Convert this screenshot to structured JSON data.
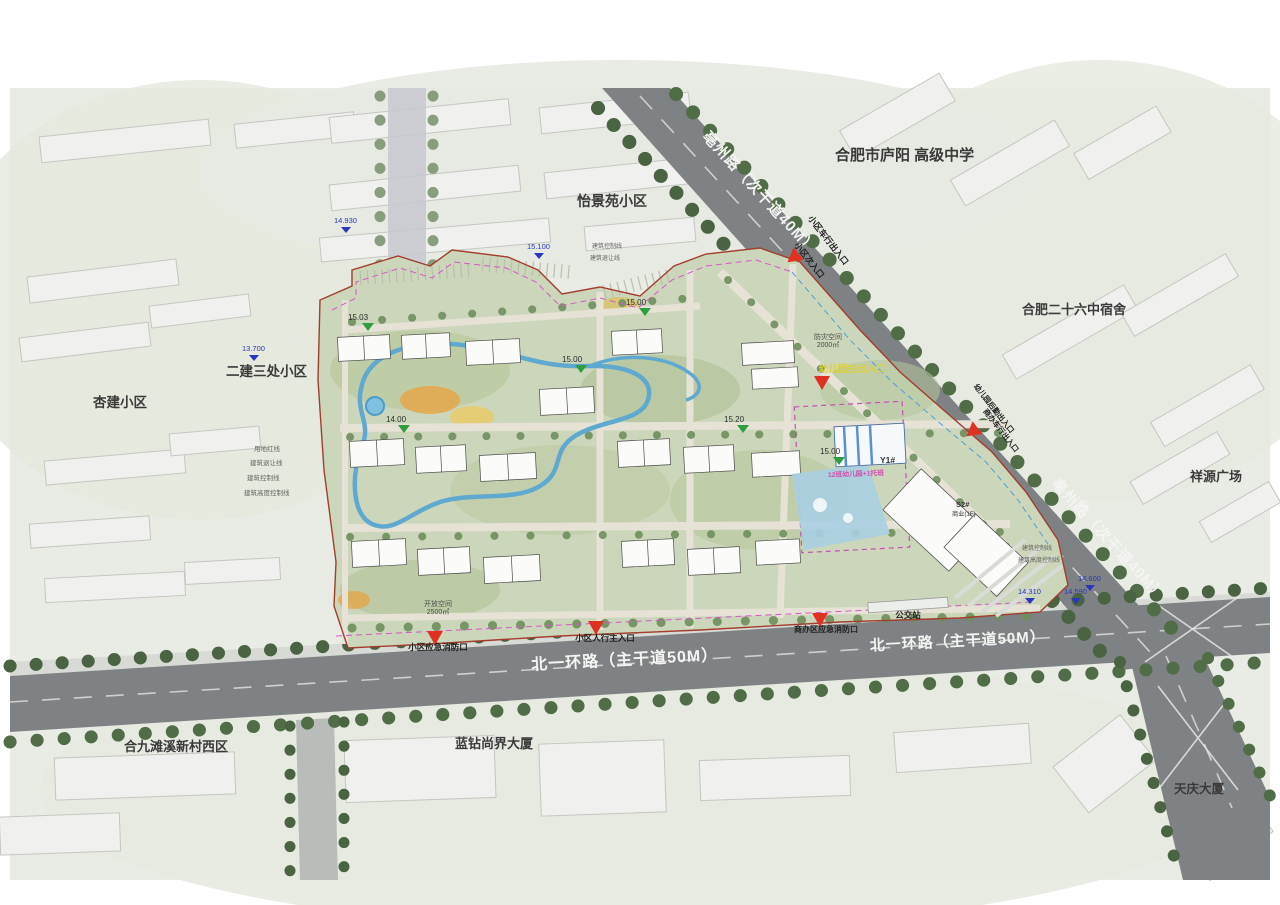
{
  "surroundings": [
    {
      "id": "yijingyuan",
      "text": "怡景苑小区"
    },
    {
      "id": "school",
      "text": "合肥市庐阳 高级中学"
    },
    {
      "id": "dorm26",
      "text": "合肥二十六中宿舍"
    },
    {
      "id": "xiangyuan",
      "text": "祥源广场"
    },
    {
      "id": "erjian",
      "text": "二建三处小区"
    },
    {
      "id": "xingjian",
      "text": "杏建小区"
    },
    {
      "id": "hejiu",
      "text": "合九滩溪新村西区"
    },
    {
      "id": "lanzuan",
      "text": "蓝钻尚界大厦"
    },
    {
      "id": "tianqing",
      "text": "天庆大厦"
    }
  ],
  "roads": {
    "bozhou": "亳州路（次干道40M）",
    "beiyihuan": "北一环路（主干道50M）"
  },
  "entrances": [
    {
      "id": "vehicle-entrance",
      "text": "小区车行出入口"
    },
    {
      "id": "secondary-entrance",
      "text": "小区次入口"
    },
    {
      "id": "kindergarten-main",
      "text": "幼儿园主出入口"
    },
    {
      "id": "kindergarten-service",
      "text": "幼儿园后勤出入口"
    },
    {
      "id": "commercial-vehicle",
      "text": "商办车行出入口"
    },
    {
      "id": "main-pedestrian",
      "text": "小区人行主入口"
    },
    {
      "id": "emergency-fire",
      "text": "小区应急消防口"
    },
    {
      "id": "commercial-emergency",
      "text": "商办区应急消防口"
    },
    {
      "id": "bus-stop",
      "text": "公交站"
    }
  ],
  "spaces": [
    {
      "id": "disaster",
      "text": "防灾空间",
      "area": "2000㎡"
    },
    {
      "id": "open",
      "text": "开放空间",
      "area": "2500㎡"
    }
  ],
  "site": {
    "kindergarten_tag": "Y1#",
    "kindergarten_name": "12班幼儿园+1托班",
    "commercial_tag": "S2#",
    "commercial_name": "商业(1F)"
  },
  "boundary_notes": [
    "用地红线",
    "建筑退让线",
    "建筑控制线",
    "建筑高度控制线"
  ],
  "elevations_blue": [
    "14.930",
    "15.100",
    "13.700",
    "14.600",
    "14.310",
    "14.590"
  ],
  "elevations_green": [
    "15.03",
    "14.00",
    "15.00",
    "15.00",
    "15.20",
    "15.00"
  ],
  "colors": {
    "site_green": "#ccd6ba",
    "road_gray": "#7f8284",
    "boundary_red": "#a33d2e",
    "water_blue": "#5fa8d0",
    "entrance_red": "#e03020",
    "setback_magenta": "#d557c8"
  }
}
